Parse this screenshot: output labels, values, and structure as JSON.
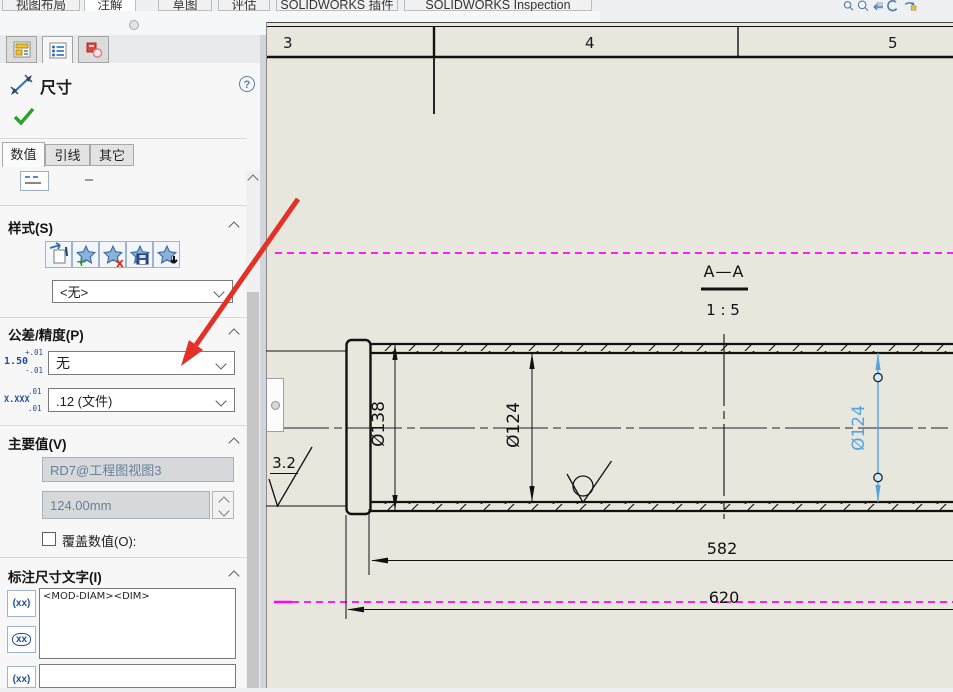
{
  "topbar": {
    "tabs": [
      "视图布局",
      "注解",
      "草图",
      "评估",
      "SOLIDWORKS 插件",
      "SOLIDWORKS Inspection"
    ],
    "active_tab": "注解"
  },
  "hud": {
    "icons": [
      "zoom-fit",
      "zoom-to-area",
      "previous-view",
      "rotate-view",
      "view-settings"
    ]
  },
  "pm_tabs": {
    "icons": [
      "feature-manager",
      "property-manager",
      "dimxpert-manager"
    ],
    "active": "property-manager"
  },
  "panel": {
    "title": "尺寸",
    "ok_tooltip": "确定",
    "tabs": [
      "数值",
      "引线",
      "其它"
    ],
    "active_tab": "数值",
    "style": {
      "label": "样式(S)",
      "preset_value": "<无>",
      "buttons": [
        "apply-default-attributes",
        "add-or-update-style",
        "delete-style",
        "save-style",
        "load-style"
      ]
    },
    "tolerance": {
      "label": "公差/精度(P)",
      "tolerance_type": "无",
      "precision": ".12 (文件)",
      "tol_icon": {
        "top": "+.01",
        "main": "1.50",
        "bottom": "-.01"
      },
      "prec_icon": {
        "top": ".01",
        "main": "X.XXX",
        "bottom": ".01"
      }
    },
    "primary_value": {
      "label": "主要值(V)",
      "name": "RD7@工程图视图3",
      "value": "124.00mm",
      "override_label": "覆盖数值(O):",
      "override_checked": false
    },
    "dim_text": {
      "label": "标注尺寸文字(I)",
      "value": "<MOD-DIAM><DIM>",
      "icon1": "(xx)",
      "icon2": "xx",
      "icon3": "(xx)"
    }
  },
  "drawing": {
    "zone_labels": [
      "3",
      "4",
      "5"
    ],
    "section_label": "A—A",
    "scale_label": "1 : 5",
    "dim_flange": "Ø138",
    "dim_bore": "Ø124",
    "dim_selected": "Ø124",
    "dim_length_inner": "582",
    "dim_length_total": "620",
    "surface_finish": "3.2"
  },
  "colors": {
    "magenta": "#ff00ff",
    "selection": "#55a3e4",
    "arrow_red": "#e43128",
    "green_check": "#2f9e2f",
    "icon_blue": "#1f4e9c",
    "drawing_bg": "#e7e7de"
  }
}
